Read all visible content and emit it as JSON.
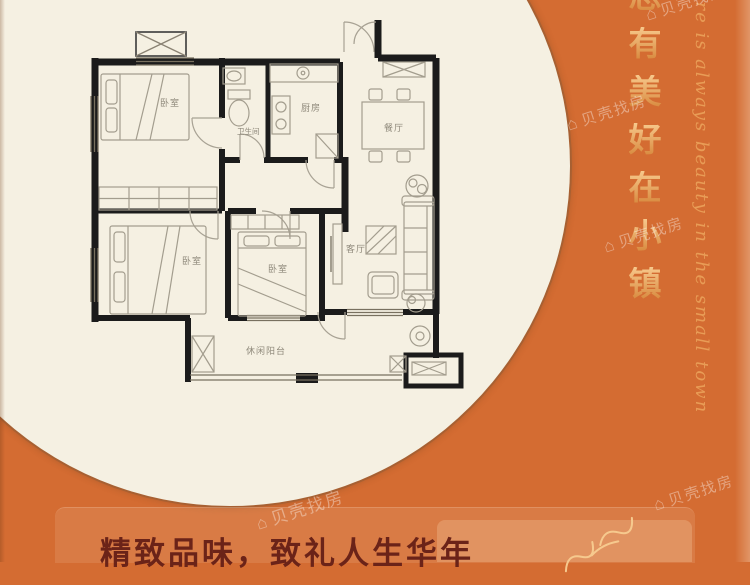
{
  "theme": {
    "background": "#d46c32",
    "circle_fill": "#f5f0e2",
    "gold_text": "#e9a35c",
    "footer_title_color": "#6b2318",
    "wall_color": "#1b1b1b"
  },
  "floor_plan": {
    "room_labels": [
      {
        "id": "bedroom-top-left",
        "label": "卧室"
      },
      {
        "id": "bathroom",
        "label": "卫生间"
      },
      {
        "id": "kitchen",
        "label": "厨房"
      },
      {
        "id": "dining-room",
        "label": "餐厅"
      },
      {
        "id": "bedroom-bottom-left",
        "label": "卧室"
      },
      {
        "id": "bedroom-bottom-middle",
        "label": "卧室"
      },
      {
        "id": "living-room",
        "label": "客厅"
      },
      {
        "id": "balcony",
        "label": "休闲阳台"
      }
    ]
  },
  "side_text": {
    "chinese_vertical": [
      "总",
      "有",
      "美",
      "好",
      "在",
      "小",
      "镇"
    ],
    "english_script": "there is always beauty in the small town"
  },
  "footer": {
    "title": "精致品味，致礼人生华年"
  },
  "watermark": {
    "logo_glyph": "⌂",
    "text": "贝壳找房"
  }
}
